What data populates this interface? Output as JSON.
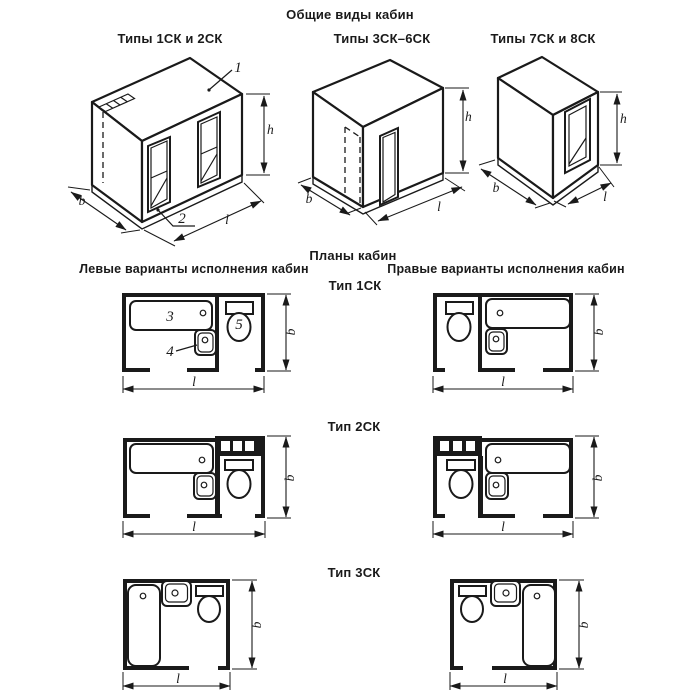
{
  "figure": {
    "title": "Общие виды кабин",
    "plans_title": "Планы кабин",
    "left_header": "Левые варианты исполнения кабин",
    "right_header": "Правые варианты исполнения кабин"
  },
  "views": [
    {
      "caption": "Типы 1СК и 2СК"
    },
    {
      "caption": "Типы 3СК–6СК"
    },
    {
      "caption": "Типы 7СК и 8СК"
    }
  ],
  "types": [
    {
      "label": "Тип 1СК"
    },
    {
      "label": "Тип 2СК"
    },
    {
      "label": "Тип 3СК"
    }
  ],
  "dims": {
    "b": "b",
    "l": "l",
    "h": "h"
  },
  "callouts": {
    "c1": "1",
    "c2": "2",
    "c3": "3",
    "c4": "4",
    "c5": "5"
  },
  "colors": {
    "ink": "#1a1a1a",
    "paper": "#ffffff"
  }
}
